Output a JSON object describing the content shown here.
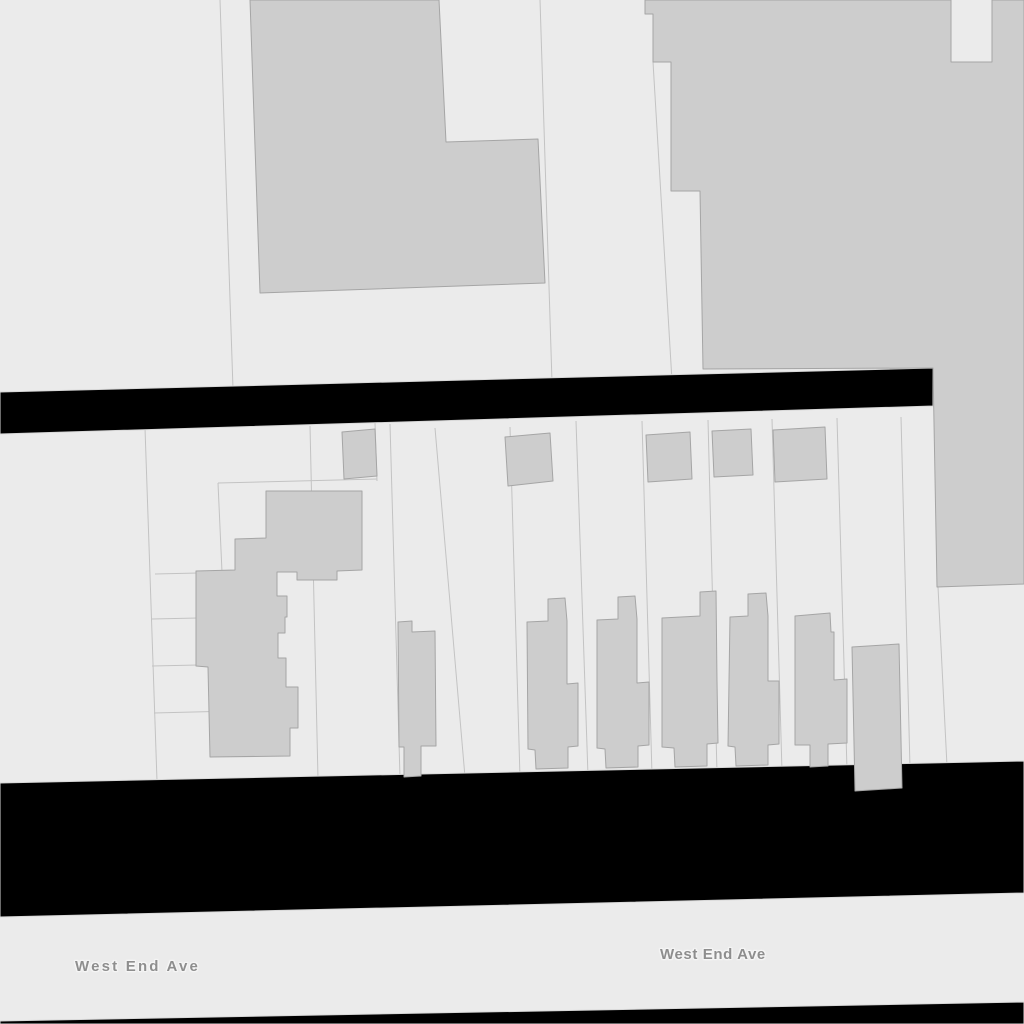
{
  "map": {
    "canvas": {
      "width": 1024,
      "height": 1024
    },
    "colors": {
      "parcel_fill": "#ebebeb",
      "parcel_line": "#c3c3c3",
      "building_fill": "#cdcdcd",
      "building_stroke": "#a5a5a5",
      "road_fill": "#000000",
      "road_edge": "#d8d8d8",
      "label_color": "#8e8e8e"
    },
    "roads": [
      {
        "name": "street-upper",
        "points": [
          [
            0,
            392
          ],
          [
            933,
            368
          ],
          [
            933,
            406
          ],
          [
            0,
            434
          ]
        ]
      },
      {
        "name": "street-lower",
        "points": [
          [
            0,
            783
          ],
          [
            1024,
            761
          ],
          [
            1024,
            893
          ],
          [
            0,
            917
          ]
        ]
      },
      {
        "name": "street-bottom-strip",
        "points": [
          [
            0,
            1021
          ],
          [
            1024,
            1002
          ],
          [
            1024,
            1024
          ],
          [
            0,
            1024
          ]
        ]
      }
    ],
    "parcel_lines": [
      [
        [
          220,
          0
        ],
        [
          233,
          389
        ]
      ],
      [
        [
          540,
          0
        ],
        [
          552,
          382
        ]
      ],
      [
        [
          653,
          62
        ],
        [
          672,
          381
        ]
      ],
      [
        [
          145,
          428
        ],
        [
          157,
          781
        ]
      ],
      [
        [
          310,
          426
        ],
        [
          318,
          779
        ]
      ],
      [
        [
          390,
          424
        ],
        [
          400,
          778
        ]
      ],
      [
        [
          435,
          428
        ],
        [
          465,
          777
        ]
      ],
      [
        [
          510,
          427
        ],
        [
          520,
          778
        ]
      ],
      [
        [
          576,
          421
        ],
        [
          588,
          776
        ]
      ],
      [
        [
          642,
          421
        ],
        [
          652,
          775
        ]
      ],
      [
        [
          708,
          420
        ],
        [
          717,
          773
        ]
      ],
      [
        [
          772,
          419
        ],
        [
          782,
          772
        ]
      ],
      [
        [
          837,
          418
        ],
        [
          847,
          770
        ]
      ],
      [
        [
          901,
          417
        ],
        [
          910,
          768
        ]
      ],
      [
        [
          938,
          587
        ],
        [
          947,
          766
        ]
      ],
      [
        [
          218,
          483
        ],
        [
          377,
          479
        ]
      ],
      [
        [
          218,
          483
        ],
        [
          222,
          572
        ]
      ],
      [
        [
          155,
          574
        ],
        [
          198,
          573
        ]
      ],
      [
        [
          152,
          619
        ],
        [
          198,
          618
        ]
      ],
      [
        [
          152,
          666
        ],
        [
          198,
          665
        ]
      ],
      [
        [
          154,
          713
        ],
        [
          233,
          711
        ]
      ],
      [
        [
          375,
          423
        ],
        [
          377,
          481
        ]
      ]
    ],
    "buildings": [
      {
        "name": "building-top-center",
        "points": [
          [
            250,
            0
          ],
          [
            439,
            0
          ],
          [
            446,
            142
          ],
          [
            538,
            139
          ],
          [
            545,
            283
          ],
          [
            260,
            293
          ]
        ]
      },
      {
        "name": "building-block-northeast",
        "points": [
          [
            645,
            0
          ],
          [
            645,
            14
          ],
          [
            653,
            14
          ],
          [
            653,
            62
          ],
          [
            671,
            62
          ],
          [
            671,
            191
          ],
          [
            700,
            191
          ],
          [
            703,
            369
          ],
          [
            933,
            368
          ],
          [
            937,
            587
          ],
          [
            1024,
            584
          ],
          [
            1024,
            0
          ],
          [
            992,
            0
          ],
          [
            992,
            62
          ],
          [
            951,
            62
          ],
          [
            951,
            0
          ]
        ]
      },
      {
        "name": "building-garage-1",
        "points": [
          [
            342,
            432
          ],
          [
            375,
            429
          ],
          [
            377,
            476
          ],
          [
            344,
            479
          ]
        ]
      },
      {
        "name": "building-garage-2",
        "points": [
          [
            505,
            437
          ],
          [
            550,
            433
          ],
          [
            553,
            481
          ],
          [
            508,
            486
          ]
        ]
      },
      {
        "name": "building-garage-3",
        "points": [
          [
            646,
            435
          ],
          [
            690,
            432
          ],
          [
            692,
            479
          ],
          [
            648,
            482
          ]
        ]
      },
      {
        "name": "building-garage-4",
        "points": [
          [
            712,
            431
          ],
          [
            751,
            429
          ],
          [
            753,
            475
          ],
          [
            714,
            477
          ]
        ]
      },
      {
        "name": "building-garage-5",
        "points": [
          [
            773,
            430
          ],
          [
            825,
            427
          ],
          [
            827,
            479
          ],
          [
            775,
            482
          ]
        ]
      },
      {
        "name": "building-complex-west",
        "points": [
          [
            266,
            491
          ],
          [
            362,
            491
          ],
          [
            362,
            570
          ],
          [
            337,
            571
          ],
          [
            337,
            580
          ],
          [
            297,
            580
          ],
          [
            297,
            572
          ],
          [
            277,
            572
          ],
          [
            277,
            596
          ],
          [
            287,
            596
          ],
          [
            287,
            617
          ],
          [
            285,
            617
          ],
          [
            285,
            633
          ],
          [
            278,
            633
          ],
          [
            278,
            658
          ],
          [
            286,
            658
          ],
          [
            286,
            687
          ],
          [
            298,
            687
          ],
          [
            298,
            728
          ],
          [
            290,
            728
          ],
          [
            290,
            756
          ],
          [
            210,
            757
          ],
          [
            208,
            667
          ],
          [
            196,
            666
          ],
          [
            196,
            571
          ],
          [
            235,
            570
          ],
          [
            235,
            539
          ],
          [
            266,
            538
          ]
        ]
      },
      {
        "name": "rowhouse-1",
        "points": [
          [
            398,
            622
          ],
          [
            412,
            621
          ],
          [
            412,
            632
          ],
          [
            435,
            631
          ],
          [
            436,
            746
          ],
          [
            421,
            746
          ],
          [
            421,
            776
          ],
          [
            404,
            777
          ],
          [
            404,
            747
          ],
          [
            399,
            747
          ]
        ]
      },
      {
        "name": "rowhouse-2",
        "points": [
          [
            527,
            622
          ],
          [
            548,
            621
          ],
          [
            548,
            599
          ],
          [
            565,
            598
          ],
          [
            567,
            621
          ],
          [
            567,
            684
          ],
          [
            578,
            683
          ],
          [
            578,
            746
          ],
          [
            568,
            747
          ],
          [
            568,
            768
          ],
          [
            536,
            769
          ],
          [
            535,
            750
          ],
          [
            528,
            749
          ]
        ]
      },
      {
        "name": "rowhouse-3",
        "points": [
          [
            597,
            620
          ],
          [
            618,
            619
          ],
          [
            618,
            597
          ],
          [
            635,
            596
          ],
          [
            637,
            619
          ],
          [
            637,
            683
          ],
          [
            649,
            682
          ],
          [
            649,
            745
          ],
          [
            638,
            746
          ],
          [
            638,
            767
          ],
          [
            606,
            768
          ],
          [
            605,
            749
          ],
          [
            597,
            748
          ]
        ]
      },
      {
        "name": "rowhouse-4",
        "points": [
          [
            662,
            618
          ],
          [
            700,
            616
          ],
          [
            700,
            592
          ],
          [
            716,
            591
          ],
          [
            717,
            681
          ],
          [
            718,
            743
          ],
          [
            707,
            744
          ],
          [
            707,
            766
          ],
          [
            675,
            767
          ],
          [
            674,
            748
          ],
          [
            662,
            747
          ]
        ]
      },
      {
        "name": "rowhouse-5",
        "points": [
          [
            730,
            617
          ],
          [
            748,
            616
          ],
          [
            748,
            594
          ],
          [
            766,
            593
          ],
          [
            768,
            616
          ],
          [
            768,
            681
          ],
          [
            779,
            681
          ],
          [
            779,
            744
          ],
          [
            768,
            745
          ],
          [
            768,
            765
          ],
          [
            736,
            766
          ],
          [
            735,
            747
          ],
          [
            728,
            746
          ]
        ]
      },
      {
        "name": "rowhouse-6",
        "points": [
          [
            795,
            616
          ],
          [
            830,
            613
          ],
          [
            831,
            632
          ],
          [
            834,
            632
          ],
          [
            834,
            680
          ],
          [
            847,
            679
          ],
          [
            847,
            743
          ],
          [
            828,
            744
          ],
          [
            828,
            766
          ],
          [
            810,
            767
          ],
          [
            810,
            745
          ],
          [
            795,
            745
          ]
        ]
      },
      {
        "name": "building-tall-east",
        "points": [
          [
            852,
            647
          ],
          [
            899,
            644
          ],
          [
            902,
            788
          ],
          [
            855,
            791
          ]
        ]
      }
    ],
    "labels": [
      {
        "text": "West End Ave",
        "x": 75,
        "y": 958,
        "font_size": 15,
        "letter_spacing": 2.2
      },
      {
        "text": "West End Ave",
        "x": 660,
        "y": 946,
        "font_size": 15,
        "letter_spacing": 0.6
      }
    ]
  }
}
